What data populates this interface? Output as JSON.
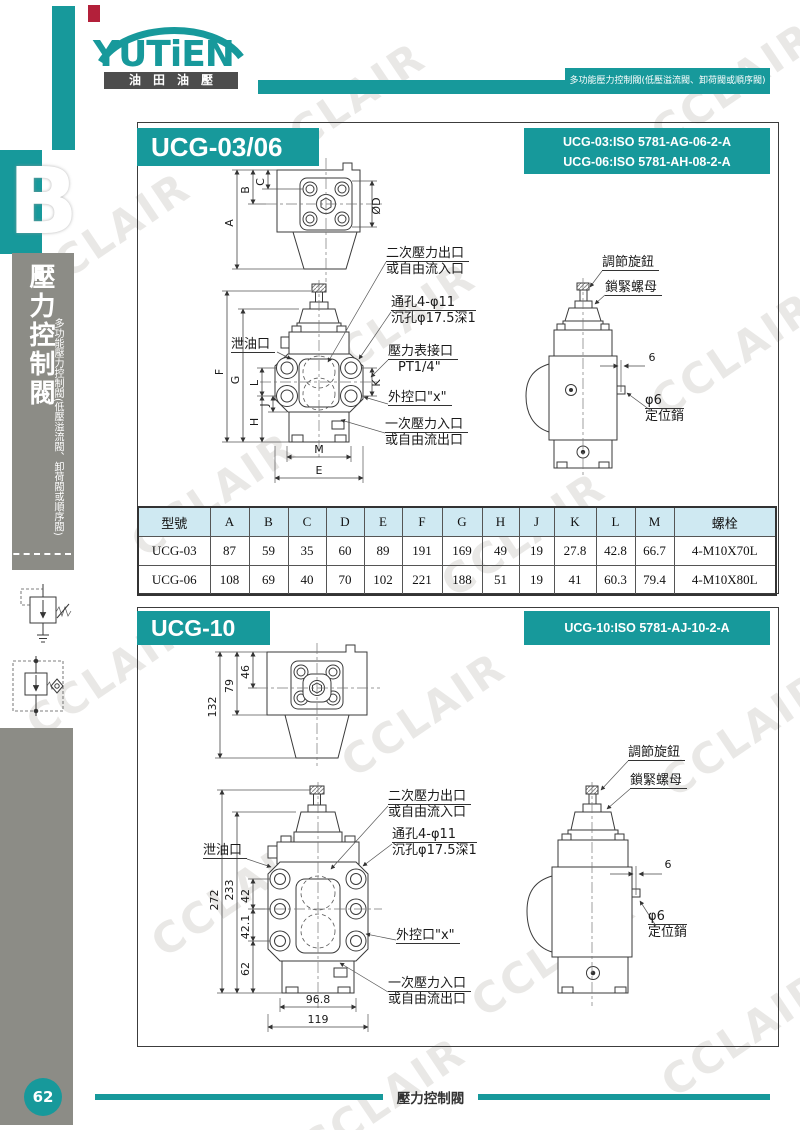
{
  "brand": {
    "logo": "YUTiEN",
    "logo_sub": "油田油壓",
    "tagline": "多功能壓力控制閥(低壓溢流閥、卸荷閥或順序閥)"
  },
  "sidebar": {
    "tab": "B",
    "title": "壓力控制閥",
    "subtitle": "多功能壓力控制閥(低壓溢流閥、卸荷閥或順序閥)",
    "page_number": "62"
  },
  "footer": {
    "title": "壓力控制閥"
  },
  "section1": {
    "title": "UCG-03/06",
    "iso": [
      "UCG-03:ISO 5781-AG-06-2-A",
      "UCG-06:ISO 5781-AH-08-2-A"
    ]
  },
  "section2": {
    "title": "UCG-10",
    "iso": [
      "UCG-10:ISO 5781-AJ-10-2-A"
    ]
  },
  "callouts": {
    "secondary1": "二次壓力出口",
    "secondary2": "或自由流入口",
    "hole1": "通孔4-φ11",
    "hole2": "沉孔φ17.5深1",
    "gauge1": "壓力表接口",
    "gauge2": "PT1/4\"",
    "external": "外控口\"x\"",
    "primary1": "一次壓力入口",
    "primary2": "或自由流出口",
    "drain": "泄油口",
    "knob": "調節旋鈕",
    "locknut": "鎖緊螺母",
    "pin_dia": "φ6",
    "pin_name": "定位銷",
    "pin_offset": "6"
  },
  "dims1": {
    "A": "A",
    "B": "B",
    "C": "C",
    "D": "ØD",
    "E": "E",
    "F": "F",
    "G": "G",
    "H": "H",
    "J": "J",
    "K": "K",
    "L": "L",
    "M": "M"
  },
  "dims2": {
    "top": [
      "132",
      "79",
      "46"
    ],
    "left": [
      "272",
      "233",
      "42",
      "42.1",
      "62"
    ],
    "bottom": [
      "96.8",
      "119"
    ]
  },
  "table": {
    "headers": [
      "型號",
      "A",
      "B",
      "C",
      "D",
      "E",
      "F",
      "G",
      "H",
      "J",
      "K",
      "L",
      "M",
      "螺栓"
    ],
    "rows": [
      [
        "UCG-03",
        "87",
        "59",
        "35",
        "60",
        "89",
        "191",
        "169",
        "49",
        "19",
        "27.8",
        "42.8",
        "66.7",
        "4-M10X70L"
      ],
      [
        "UCG-06",
        "108",
        "69",
        "40",
        "70",
        "102",
        "221",
        "188",
        "51",
        "19",
        "41",
        "60.3",
        "79.4",
        "4-M10X80L"
      ]
    ]
  },
  "watermark": "CCLAIR"
}
